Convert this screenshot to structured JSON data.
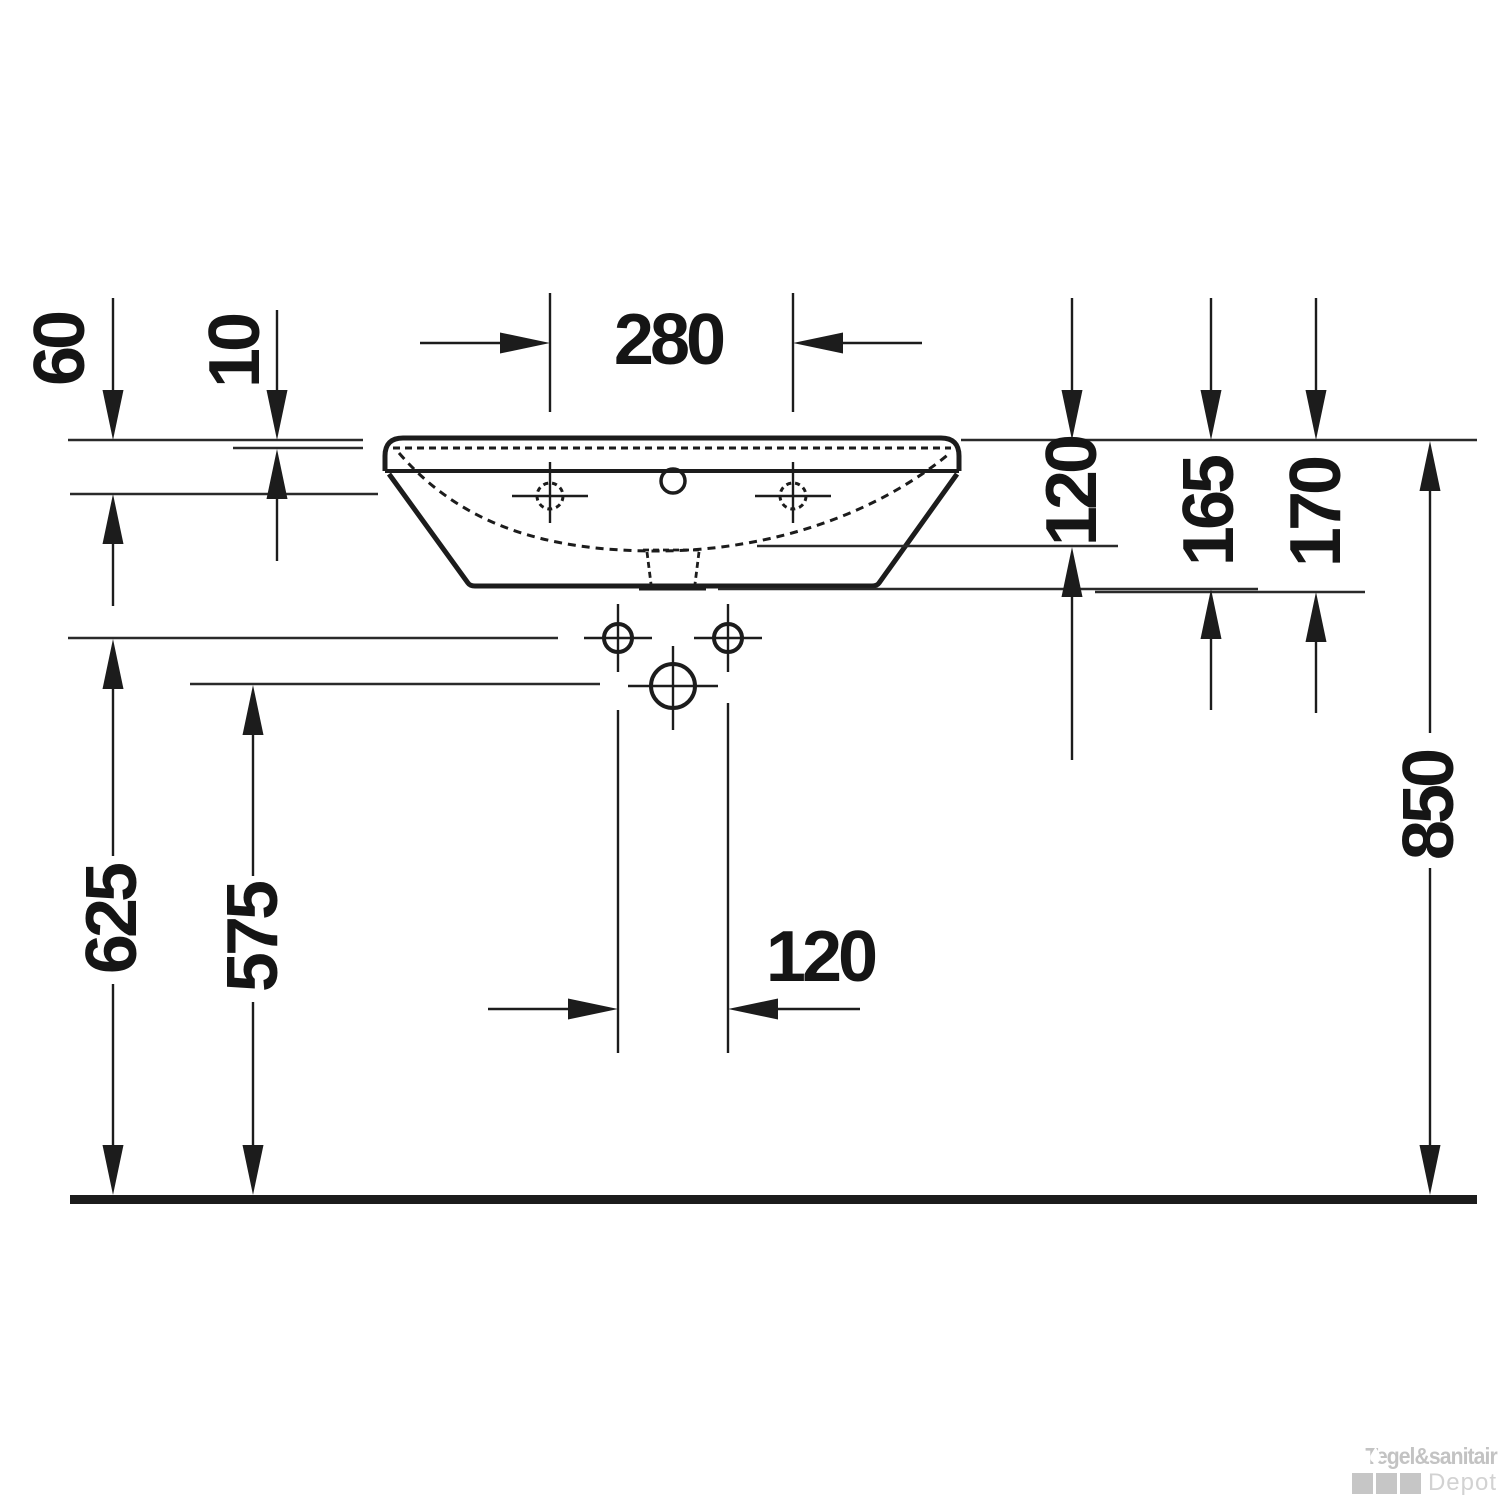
{
  "drawing": {
    "type": "washbasin front elevation installation drawing",
    "line_color": "#1c1c1c",
    "background": "#ffffff",
    "dimensions": {
      "d60": "60",
      "d10": "10",
      "d280": "280",
      "d120_right": "120",
      "d165": "165",
      "d170": "170",
      "d850": "850",
      "d625": "625",
      "d575": "575",
      "d120_bottom": "120"
    },
    "watermark": {
      "brand": "Tegel&sanitair",
      "sub": "Depot",
      "brand_color": "#c3c3c3",
      "sub_color": "#d2d2d2"
    }
  }
}
